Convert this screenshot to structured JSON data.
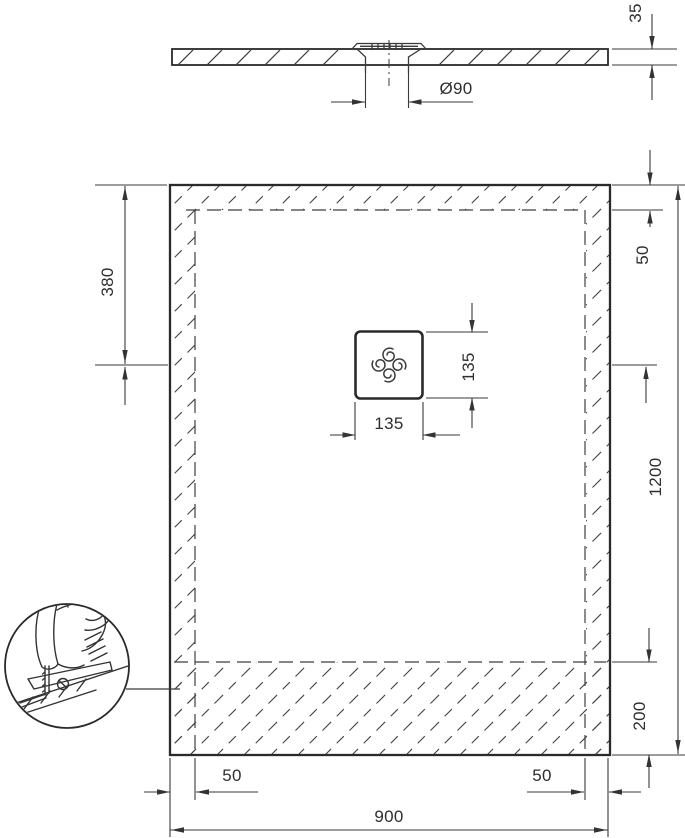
{
  "title": "shower-tray-technical-drawing",
  "colors": {
    "line": "#3a3a3a",
    "line_heavy": "#2a2a2a",
    "text": "#2e2e2e",
    "background": "#ffffff"
  },
  "section_view": {
    "tray_thickness": "35",
    "drain_diameter": "Ø90"
  },
  "plan_view": {
    "tray_width": "900",
    "tray_length": "1200",
    "drain_offset_from_top": "380",
    "drain_cover_width": "135",
    "drain_cover_height": "135",
    "cut_zone_top": "50",
    "cut_zone_bottom": "200",
    "cut_zone_left": "50",
    "cut_zone_right": "50"
  },
  "icons": {
    "jigsaw": "jigsaw-icon",
    "drain_cover": "drain-cover-icon"
  }
}
